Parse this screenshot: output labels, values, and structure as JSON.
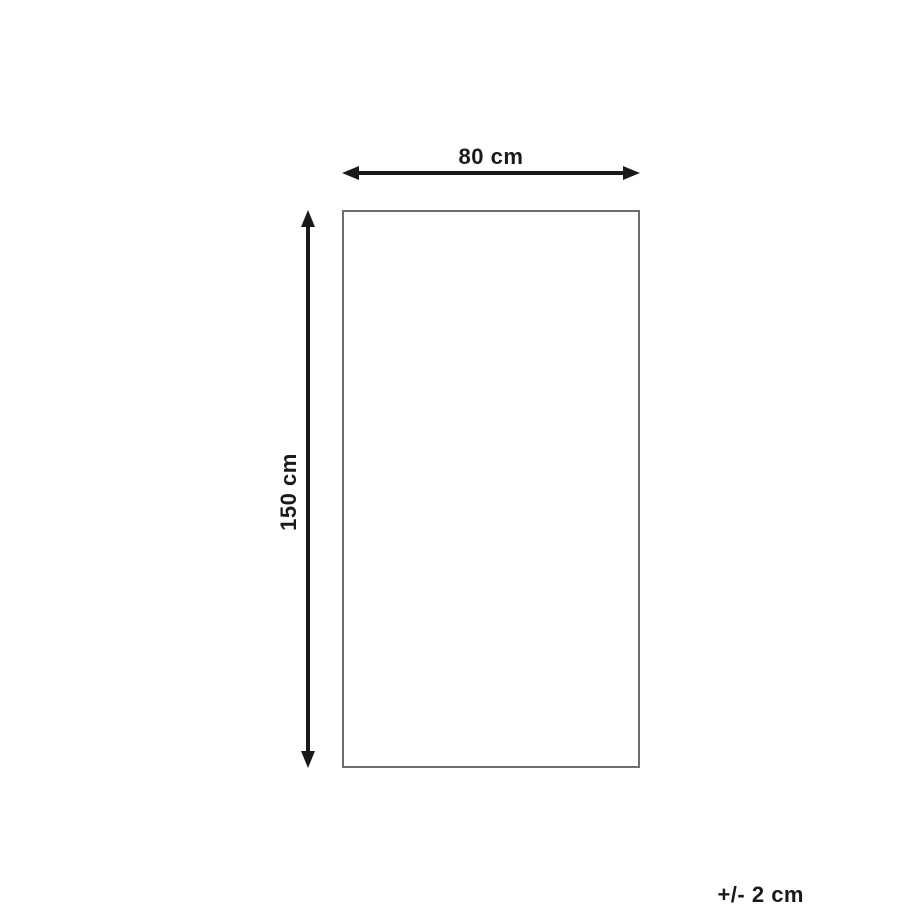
{
  "diagram": {
    "type": "product-dimensions",
    "width_dimension": {
      "label": "80 cm",
      "value_cm": 80
    },
    "height_dimension": {
      "label": "150 cm",
      "value_cm": 150
    },
    "tolerance": {
      "label": "+/- 2 cm",
      "value_cm": 2
    },
    "colors": {
      "arrow": "#1a1a1a",
      "rectangle_border": "#6e6e6e",
      "background": "#ffffff"
    }
  }
}
